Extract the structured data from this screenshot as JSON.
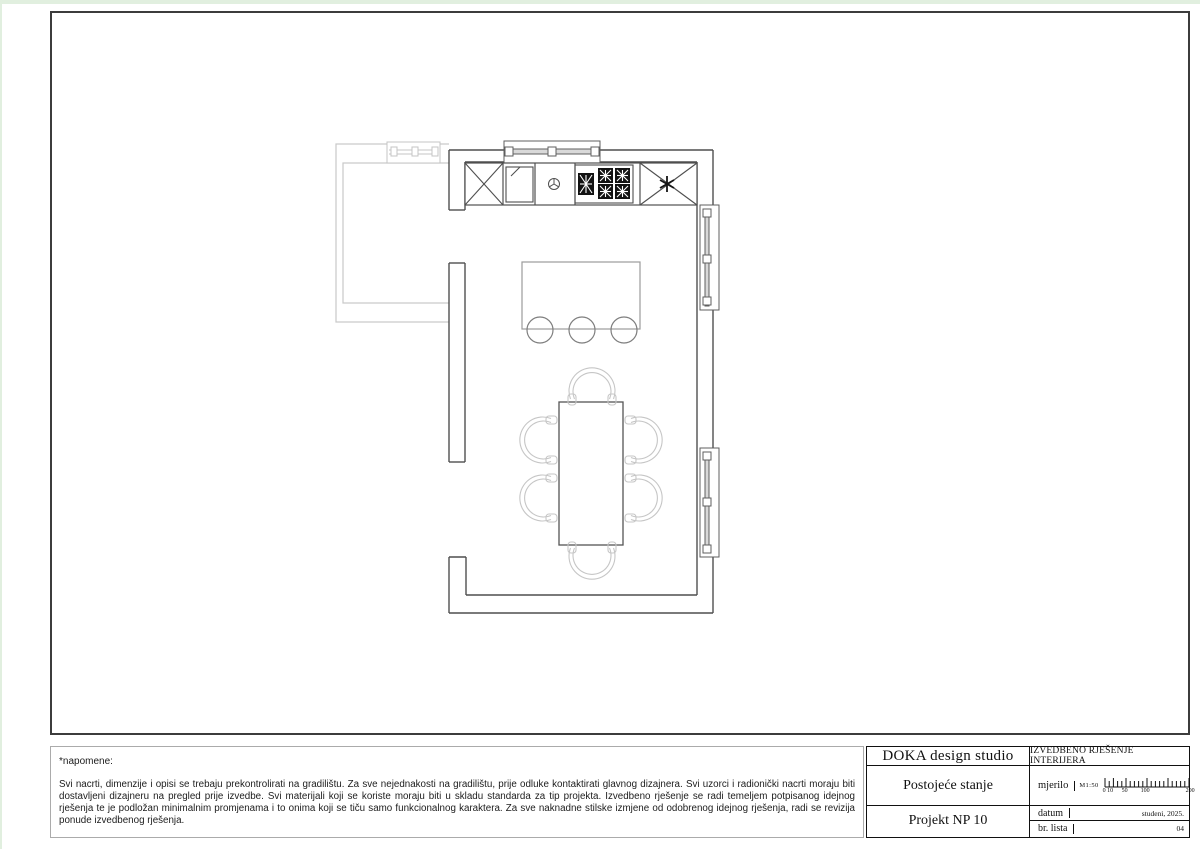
{
  "page": {
    "edge_color": "#e1efdf",
    "sheet_color": "#ffffff",
    "wall_color": "#4f4f4f",
    "furniture_color": "#c6c6c6",
    "appliance_color": "#121212"
  },
  "plan": {
    "elements": [
      "adjacent-room",
      "window",
      "tall-cabinet",
      "sink-cabinet",
      "cooktop-burners",
      "refrigerator-cabinet",
      "kitchen-island",
      "bar-stools",
      "dining-table",
      "dining-chairs"
    ]
  },
  "notes": {
    "title": "*napomene:",
    "body": "Svi nacrti, dimenzije i opisi se trebaju prekontrolirati na gradilištu. Za sve nejednakosti na gradilištu, prije odluke kontaktirati glavnog dizajnera. Svi uzorci i radionički nacrti moraju biti dostavljeni dizajneru na pregled prije izvedbe. Svi materijali koji se koriste moraju biti u skladu standarda za tip projekta. Izvedbeno rješenje se radi temeljem potpisanog idejnog rješenja te je podložan minimalnim promjenama i to onima koji se tiču samo funkcionalnog karaktera. Za sve naknadne stilske izmjene od odobrenog idejnog rješenja, radi se revizija ponude izvedbenog rješenja."
  },
  "title_block": {
    "studio_name": "DOKA design studio",
    "document_type": "IZVEDBENO RJEŠENJE INTERIJERA",
    "drawing_title": "Postojeće stanje",
    "project_name": "Projekt NP 10",
    "scale_label": "mjerilo",
    "scale_value": "M1:50",
    "scale_ticks": [
      "0 10",
      "50",
      "100",
      "200"
    ],
    "date_label": "datum",
    "date_value": "studeni, 2025.",
    "sheet_label": "br. lista",
    "sheet_value": "04"
  }
}
